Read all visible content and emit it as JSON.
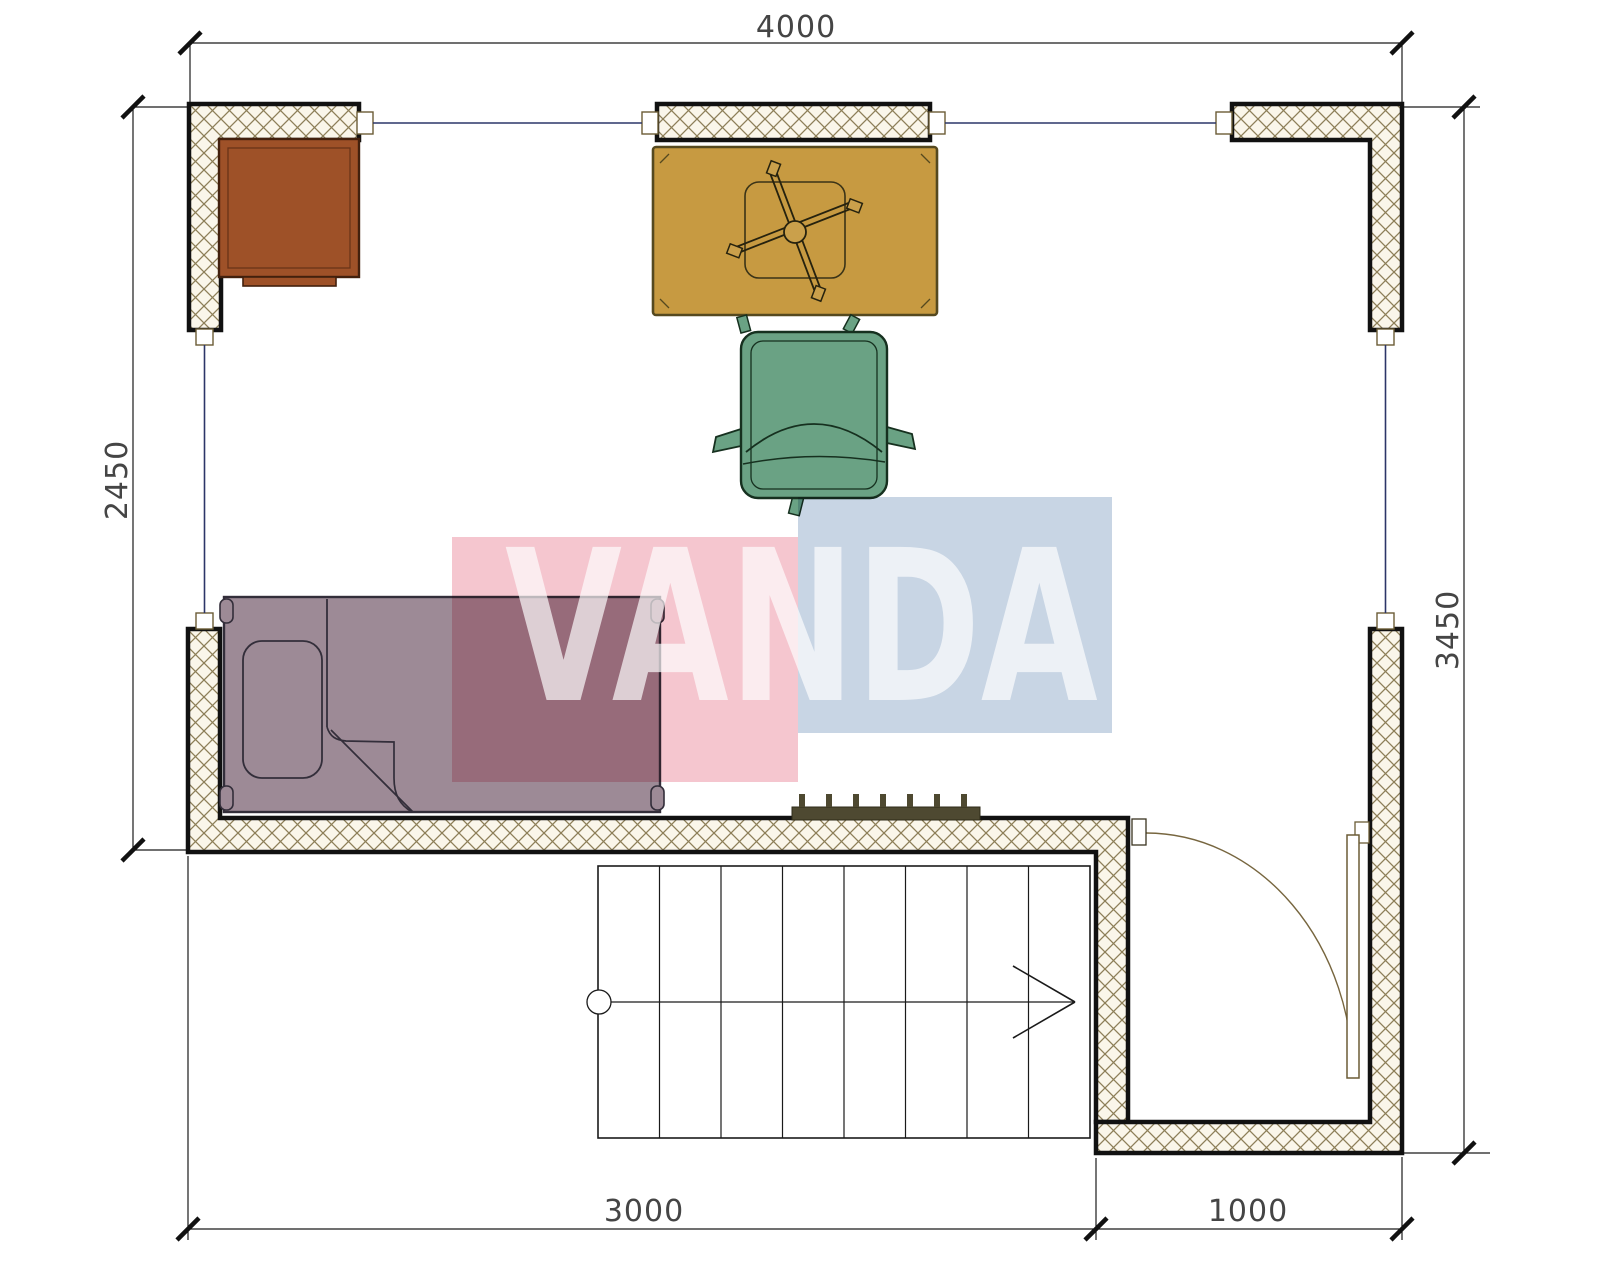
{
  "title": "apartment-floor-plan",
  "dims": {
    "top": {
      "label": "4000",
      "orientation": "horizontal"
    },
    "left": {
      "label": "2450",
      "orientation": "vertical"
    },
    "right": {
      "label": "3450",
      "orientation": "vertical"
    },
    "bottom_left": {
      "label": "3000",
      "orientation": "horizontal"
    },
    "bottom_right": {
      "label": "1000",
      "orientation": "horizontal"
    }
  },
  "watermark": {
    "text": "VANDA",
    "pink": "#f5c6cf",
    "blue": "#c8d5e4",
    "text_color": "#ffffff"
  },
  "colors": {
    "desk": "#9e5128",
    "table": "#c79a41",
    "table_trim": "#55491f",
    "chair": "#6aa284",
    "bed": "#9d8a96",
    "radiator": "#4e4931",
    "wall_bg": "#faf6ea",
    "wall_hatch": "#8d7f58",
    "wall_outline": "#111111",
    "window_line": "#2c3668",
    "dim_line": "#1a1a1a",
    "dim_text": "#454545",
    "door": "#77663f",
    "stair_line": "#1a1a1a"
  },
  "elements": [
    {
      "name": "desk",
      "kind": "furniture"
    },
    {
      "name": "work-table",
      "kind": "furniture"
    },
    {
      "name": "desk-chair-base",
      "kind": "furniture"
    },
    {
      "name": "armchair",
      "kind": "furniture"
    },
    {
      "name": "single-bed",
      "kind": "furniture"
    },
    {
      "name": "radiator",
      "kind": "fixture"
    },
    {
      "name": "staircase",
      "kind": "structure"
    },
    {
      "name": "entry-door",
      "kind": "structure"
    },
    {
      "name": "window",
      "kind": "structure"
    }
  ]
}
